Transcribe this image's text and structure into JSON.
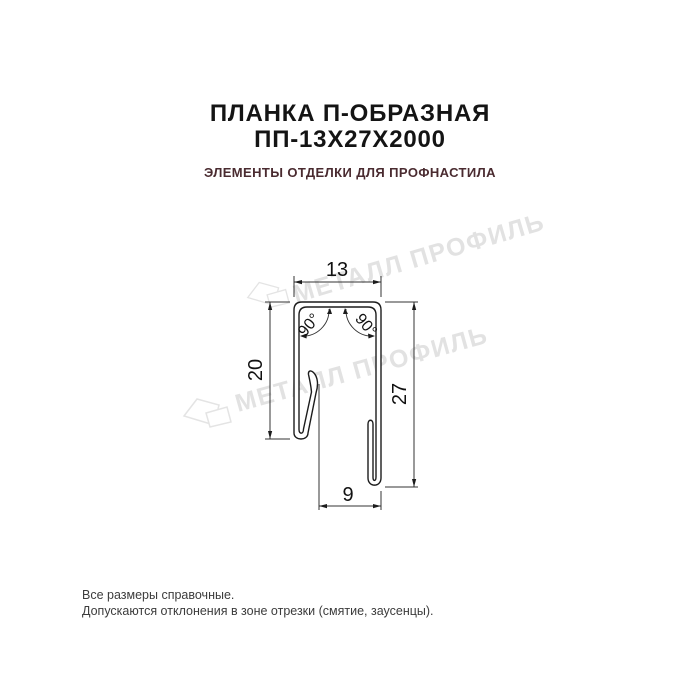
{
  "header": {
    "title_line1": "ПЛАНКА П-ОБРАЗНАЯ",
    "title_line2": "ПП-13Х27Х2000",
    "subtitle": "ЭЛЕМЕНТЫ ОТДЕЛКИ ДЛЯ ПРОФНАСТИЛА"
  },
  "drawing": {
    "description": "dimensioned cross-section of U-shaped strip",
    "dim_width_top": {
      "value": "13"
    },
    "dim_height_left": {
      "value": "20"
    },
    "dim_height_right": {
      "value": "27"
    },
    "dim_width_bottom": {
      "value": "9"
    },
    "angle_left": {
      "value": "90°"
    },
    "angle_right": {
      "value": "90°"
    }
  },
  "watermark": {
    "text": "МЕТАЛЛ ПРОФИЛЬ"
  },
  "footer": {
    "line1": "Все размеры справочные.",
    "line2": "Допускаются отклонения в зоне отрезки (смятие, заусенцы)."
  },
  "colors": {
    "background": "#ffffff",
    "title": "#141414",
    "subtitle": "#4a2b30",
    "drawing_line": "#1c1c1c",
    "dimension_line": "#333333",
    "watermark": "#e2e2e2",
    "footer_text": "#3c3c3c"
  }
}
